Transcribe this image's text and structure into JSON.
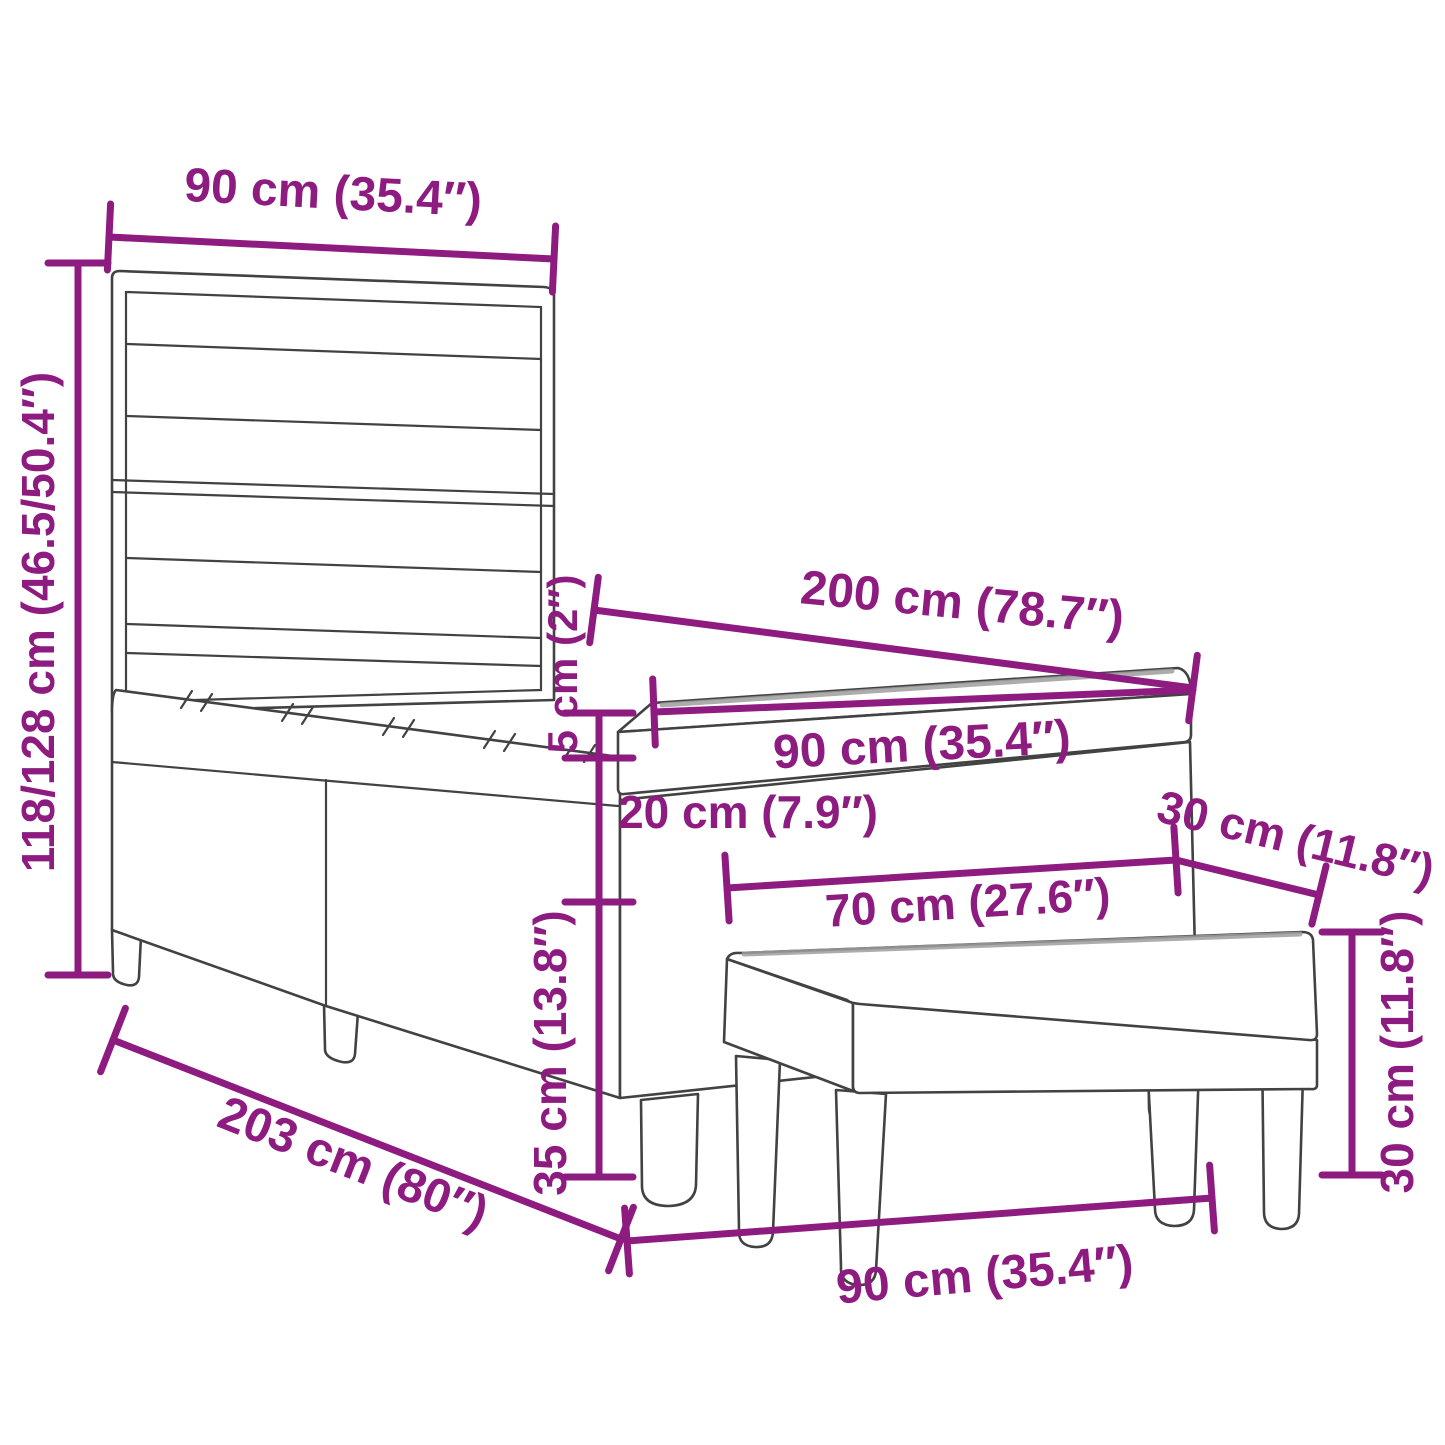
{
  "diagram": {
    "title": "bed-with-bench-dimension-diagram",
    "accent_color": "#8E1B80",
    "line_color": "#424242",
    "background_color": "#FFFFFF",
    "labels": {
      "headboard_width": "90 cm (35.4″)",
      "bed_height": "118/128 cm (46.5/50.4″)",
      "mattress_length": "200 cm (78.7″)",
      "mattress_width": "90 cm (35.4″)",
      "topper_thickness": "5 cm (2″)",
      "base_height": "20 cm (7.9″)",
      "frame_height": "35 cm (13.8″)",
      "bench_length": "70 cm (27.6″)",
      "bench_depth": "30 cm (11.8″)",
      "bench_height": "30 cm (11.8″)",
      "total_length": "203 cm (80″)",
      "bed_width": "90 cm (35.4″)"
    }
  }
}
